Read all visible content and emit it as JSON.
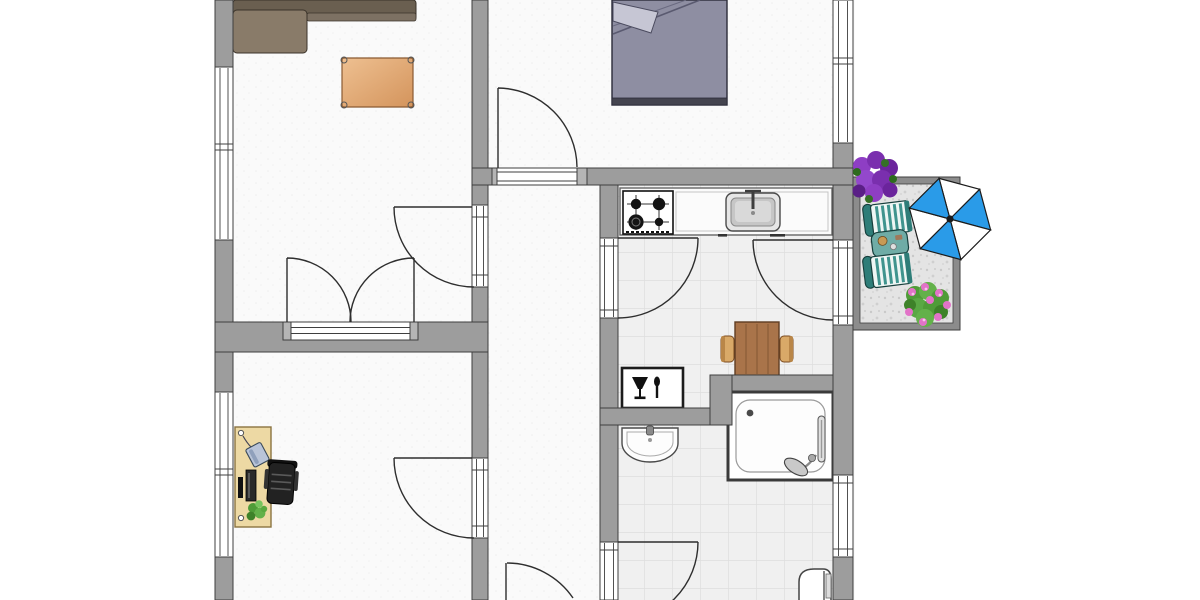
{
  "floor_plan": {
    "type": "apartment-floor-plan-top-view",
    "rooms": [
      {
        "id": "living-room",
        "position": "top-left",
        "furniture": [
          "corner-sofa",
          "area-rug"
        ]
      },
      {
        "id": "office",
        "position": "bottom-left",
        "furniture": [
          "desk",
          "telephone",
          "monitor",
          "desk-plant",
          "office-chair"
        ]
      },
      {
        "id": "bedroom",
        "position": "top-center",
        "furniture": [
          "double-bed",
          "pillow",
          "blanket"
        ]
      },
      {
        "id": "hallway",
        "position": "center-vertical",
        "furniture": []
      },
      {
        "id": "kitchen-dining",
        "position": "center-right",
        "furniture": [
          "kitchen-counter",
          "gas-stove-4-burner",
          "kitchen-sink",
          "dining-table",
          "dining-chair-left",
          "dining-chair-right",
          "dining-plaque"
        ]
      },
      {
        "id": "bathroom",
        "position": "bottom-right",
        "furniture": [
          "wash-basin",
          "shower-cabin",
          "toilet"
        ]
      },
      {
        "id": "balcony",
        "position": "right",
        "furniture": [
          "purple-flower-bush",
          "lounge-chair-upper",
          "side-table",
          "lounge-chair-lower",
          "parasol",
          "pink-flower-bush"
        ]
      }
    ],
    "windows": [
      {
        "wall": "left",
        "room": "living-room"
      },
      {
        "wall": "left",
        "room": "office"
      },
      {
        "wall": "right",
        "room": "bedroom"
      },
      {
        "wall": "right",
        "room": "bathroom"
      }
    ],
    "doors": [
      {
        "from": "hallway",
        "to": "bedroom",
        "type": "single"
      },
      {
        "from": "hallway",
        "to": "living-room",
        "type": "single"
      },
      {
        "from": "hallway",
        "to": "office",
        "type": "single"
      },
      {
        "from": "hallway",
        "to": "kitchen-dining",
        "type": "single"
      },
      {
        "from": "hallway",
        "to": "bathroom",
        "type": "single"
      },
      {
        "from": "living-room",
        "to": "office",
        "type": "double"
      },
      {
        "from": "kitchen-dining",
        "to": "balcony",
        "type": "single"
      },
      {
        "from": "hallway",
        "to": "outside",
        "type": "entrance-partially-cropped"
      }
    ],
    "plaque_icons": [
      "wine-glass-icon",
      "fork-icon"
    ]
  },
  "colors": {
    "wall": "#9d9d9d",
    "wall_outline": "#3f3f3f",
    "floor_white": "#fafafa",
    "tile": "#f0f0f0",
    "balcony_floor": "#e4e4e4",
    "sofa_back": "#6a5f50",
    "sofa_seat": "#897b69",
    "rug_light": "#eec091",
    "rug_dark": "#d4945c",
    "bed": "#8e8ea2",
    "bed_footboard": "#44444f",
    "wood": "#a9744a",
    "chair_tan": "#d9a968",
    "desk": "#edd9a4",
    "stove": "#141414",
    "sink_metal": "#c6c6c6",
    "umbrella_blue": "#2a9be8",
    "lounge_teal": "#3f948e",
    "plant_green": "#4f9c38",
    "flower_purple": "#8e3ec4",
    "flower_pink": "#e273c8"
  }
}
